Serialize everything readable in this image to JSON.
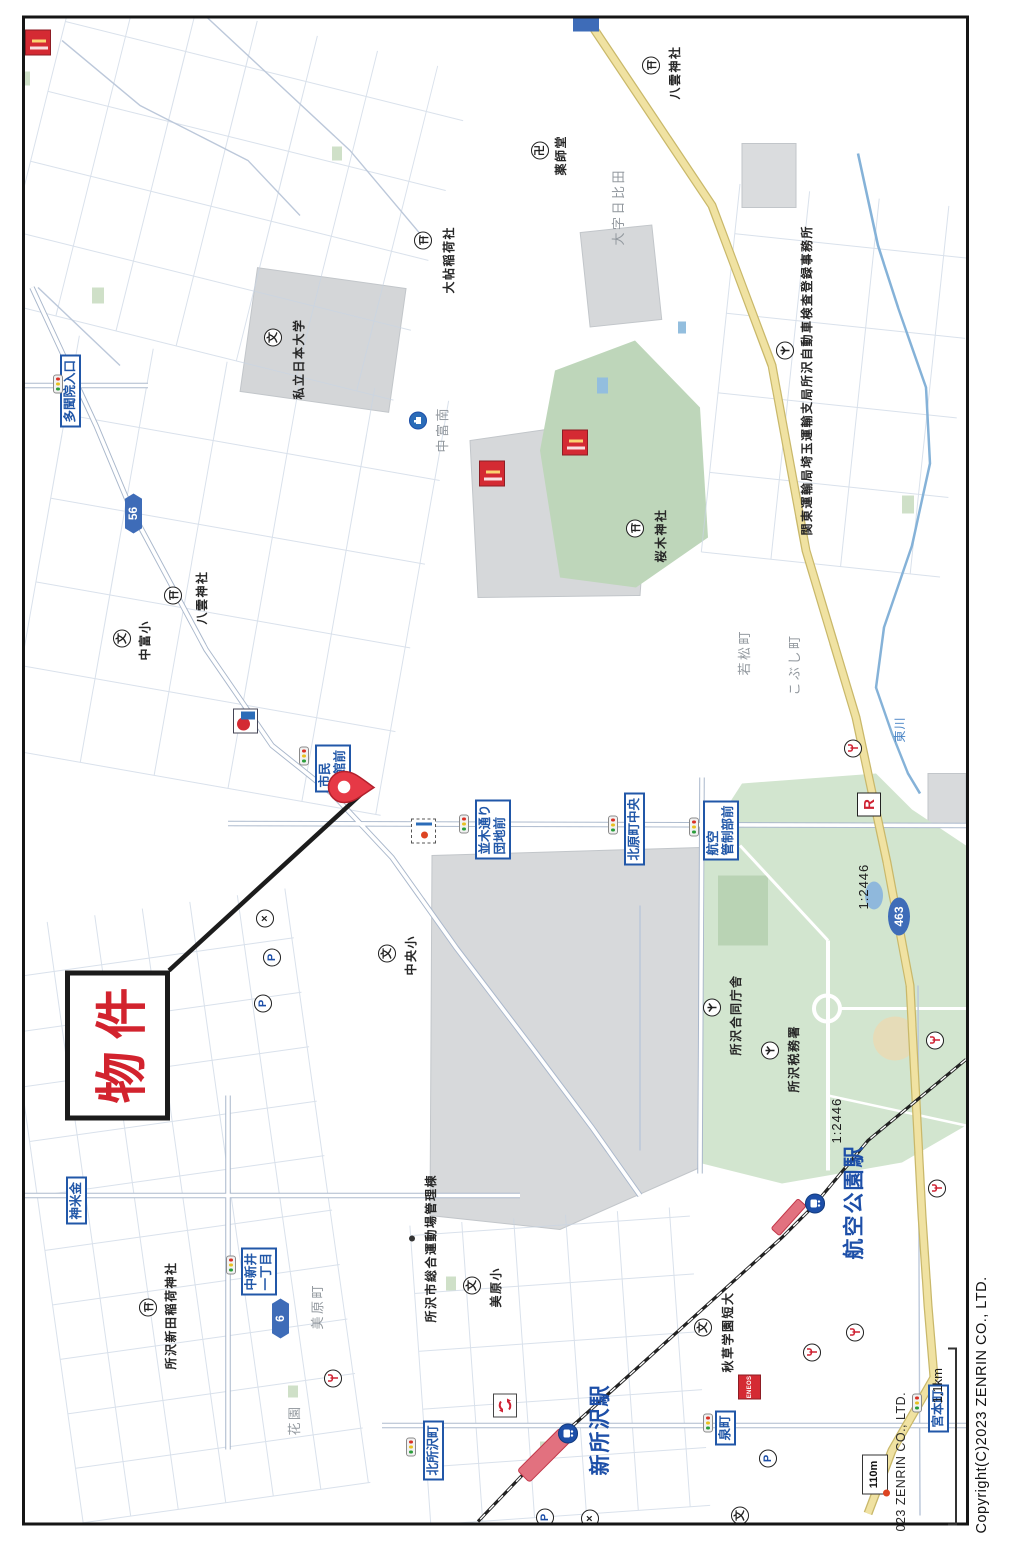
{
  "page": {
    "copyright": "Copyright(C)2023 ZENRIN CO., LTD.",
    "map_partial_copyright": "023 ZENRIN CO., LTD.",
    "scale_bar_label": "1.1km"
  },
  "property": {
    "label": "物件"
  },
  "route_shields": [
    {
      "text": "56",
      "shape": "hex",
      "x": 1012,
      "y": 125
    },
    {
      "text": "6",
      "shape": "hex",
      "x": 207,
      "y": 272
    },
    {
      "text": "463",
      "shape": "oval",
      "x": 610,
      "y": 888
    }
  ],
  "scale_texts": [
    {
      "text": "1:2446",
      "x": 636,
      "y": 856
    },
    {
      "text": "1:2446",
      "x": 402,
      "y": 829
    }
  ],
  "boxed_labels": [
    {
      "name": "tamonin-iriguchi",
      "lines": [
        "多聞院入口"
      ],
      "x": 1118,
      "y": 60
    },
    {
      "name": "shimin-dokan-mae",
      "lines": [
        "市民",
        "道館前"
      ],
      "x": 753,
      "y": 315
    },
    {
      "name": "namiki-dori-danchi-mae",
      "lines": [
        "並木通り",
        "団地前"
      ],
      "x": 686,
      "y": 475
    },
    {
      "name": "kitahara-cho-chuo",
      "lines": [
        "北原町中央"
      ],
      "x": 680,
      "y": 624
    },
    {
      "name": "koku-kansei-bu-mae",
      "lines": [
        "航空",
        "管制部前"
      ],
      "x": 685,
      "y": 703
    },
    {
      "name": "kamegome",
      "lines": [
        "神米金"
      ],
      "x": 321,
      "y": 66
    },
    {
      "name": "nakaarai-itchome",
      "lines": [
        "中新井",
        "一丁目"
      ],
      "x": 250,
      "y": 241
    },
    {
      "name": "kita-tokorozawa-cho",
      "lines": [
        "北所沢町"
      ],
      "x": 65,
      "y": 423
    },
    {
      "name": "izumi-cho",
      "lines": [
        "泉町"
      ],
      "x": 100,
      "y": 715
    },
    {
      "name": "miyamoto-cho",
      "lines": [
        "宮本町"
      ],
      "x": 113,
      "y": 928
    }
  ],
  "station_names": [
    {
      "name": "shin-tokorozawa-station",
      "text": "新所沢駅",
      "x": 70,
      "y": 584
    },
    {
      "name": "koku-koen-station",
      "text": "航空公園駅",
      "x": 286,
      "y": 838
    }
  ],
  "district_names": [
    {
      "text": "大字日比田",
      "x": 1300,
      "y": 608
    },
    {
      "text": "大字中新井",
      "x": 480,
      "y": 152
    },
    {
      "text": "中富南",
      "x": 1093,
      "y": 432
    },
    {
      "text": "若松町",
      "x": 870,
      "y": 734
    },
    {
      "text": "こぶし町",
      "x": 850,
      "y": 784
    },
    {
      "text": "花園",
      "x": 110,
      "y": 284
    },
    {
      "text": "美原町",
      "x": 216,
      "y": 307
    }
  ],
  "water_names": [
    {
      "text": "東川",
      "x": 803,
      "y": 891
    }
  ],
  "poi_names": [
    {
      "text": "八雲神社",
      "x": 1446,
      "y": 666
    },
    {
      "text": "薬師堂",
      "x": 1370,
      "y": 552
    },
    {
      "text": "大帖稲荷社",
      "x": 1252,
      "y": 440
    },
    {
      "text": "私立日本大学",
      "x": 1146,
      "y": 290
    },
    {
      "text": "八雲神社",
      "x": 921,
      "y": 193
    },
    {
      "text": "中富小",
      "x": 885,
      "y": 136
    },
    {
      "text": "桜木神社",
      "x": 983,
      "y": 652
    },
    {
      "text": "関東運輸局埼玉運輸支局所沢自動車検査登録事務所",
      "x": 1010,
      "y": 798
    },
    {
      "text": "所沢合同庁舎",
      "x": 490,
      "y": 727
    },
    {
      "text": "所沢税務署",
      "x": 453,
      "y": 785
    },
    {
      "text": "中央小",
      "x": 570,
      "y": 402
    },
    {
      "text": "美原小",
      "x": 238,
      "y": 487
    },
    {
      "text": "所沢市総合運動場管理棟",
      "x": 223,
      "y": 422
    },
    {
      "text": "秋草学園短大",
      "x": 173,
      "y": 719
    },
    {
      "text": "所沢新田稲荷神社",
      "x": 176,
      "y": 162
    }
  ],
  "icons": [
    {
      "type": "torii",
      "x": 1480,
      "y": 651
    },
    {
      "type": "torii",
      "x": 1305,
      "y": 423
    },
    {
      "type": "torii",
      "x": 950,
      "y": 173
    },
    {
      "type": "torii",
      "x": 1017,
      "y": 635
    },
    {
      "type": "torii",
      "x": 238,
      "y": 148
    },
    {
      "type": "school",
      "glyph": "文",
      "x": 1208,
      "y": 273
    },
    {
      "type": "school",
      "glyph": "文",
      "x": 907,
      "y": 122
    },
    {
      "type": "school",
      "glyph": "文",
      "x": 592,
      "y": 387
    },
    {
      "type": "school",
      "glyph": "文",
      "x": 260,
      "y": 472
    },
    {
      "type": "school",
      "glyph": "文",
      "x": 218,
      "y": 703
    },
    {
      "type": "school",
      "glyph": "文",
      "x": 30,
      "y": 740
    },
    {
      "type": "temple",
      "glyph": "卍",
      "x": 1395,
      "y": 540
    },
    {
      "type": "gov",
      "x": 1195,
      "y": 785
    },
    {
      "type": "gov",
      "x": 538,
      "y": 712
    },
    {
      "type": "gov",
      "x": 495,
      "y": 770
    },
    {
      "type": "police",
      "glyph": "×",
      "x": 627,
      "y": 265
    },
    {
      "type": "police",
      "glyph": "×",
      "x": 27,
      "y": 590
    },
    {
      "type": "parking",
      "glyph": "P",
      "x": 588,
      "y": 272
    },
    {
      "type": "parking",
      "glyph": "P",
      "x": 542,
      "y": 263
    },
    {
      "type": "parking",
      "glyph": "P",
      "x": 28,
      "y": 545
    },
    {
      "type": "parking",
      "glyph": "P",
      "x": 87,
      "y": 768
    },
    {
      "type": "fork",
      "x": 797,
      "y": 853
    },
    {
      "type": "fork",
      "x": 357,
      "y": 937
    },
    {
      "type": "fork",
      "x": 213,
      "y": 855
    },
    {
      "type": "fork",
      "x": 193,
      "y": 812
    },
    {
      "type": "fork",
      "x": 167,
      "y": 333
    },
    {
      "type": "fork",
      "x": 505,
      "y": 935
    },
    {
      "type": "light",
      "x": 1160,
      "y": 57
    },
    {
      "type": "light",
      "x": 788,
      "y": 303
    },
    {
      "type": "light",
      "x": 720,
      "y": 463
    },
    {
      "type": "light",
      "x": 719,
      "y": 612
    },
    {
      "type": "light",
      "x": 717,
      "y": 693
    },
    {
      "type": "light",
      "x": 279,
      "y": 230
    },
    {
      "type": "light",
      "x": 97,
      "y": 410
    },
    {
      "type": "light",
      "x": 121,
      "y": 707
    },
    {
      "type": "light",
      "x": 141,
      "y": 916
    },
    {
      "type": "train",
      "x": 342,
      "y": 815
    },
    {
      "type": "train",
      "x": 112,
      "y": 568
    },
    {
      "type": "bluefac",
      "x": 1125,
      "y": 418
    },
    {
      "type": "restR",
      "glyph": "R",
      "x": 741,
      "y": 869
    },
    {
      "type": "roundabout",
      "x": 140,
      "y": 505
    },
    {
      "type": "sign",
      "x": 714,
      "y": 423
    },
    {
      "type": "gas-idemitsu",
      "x": 824,
      "y": 245
    },
    {
      "type": "gas-eneos",
      "text": "ENEOS",
      "x": 158,
      "y": 749
    },
    {
      "type": "redstore",
      "x": 1072,
      "y": 492
    },
    {
      "type": "redstore",
      "x": 1103,
      "y": 575
    },
    {
      "type": "redstore",
      "x": 1503,
      "y": 38
    },
    {
      "type": "dot",
      "x": 307,
      "y": 412
    },
    {
      "type": "marker110",
      "text": "110m",
      "x": 70,
      "y": 874
    }
  ]
}
